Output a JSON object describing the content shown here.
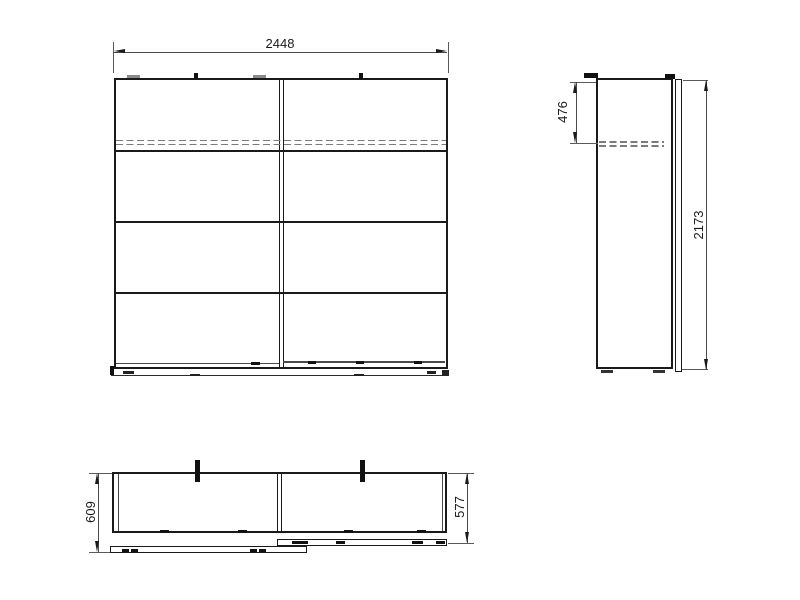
{
  "meta": {
    "background": "#ffffff",
    "object_line_color": "#1a1a1a",
    "dimension_line_color": "#4a4a4a",
    "hidden_line_color": "#7b7b7b"
  },
  "drawing": {
    "views": {
      "front": {
        "width_label": "2448"
      },
      "side": {
        "rail_depth_label": "476",
        "height_label": "2173"
      },
      "top": {
        "total_depth_label": "609",
        "carcass_depth_label": "577"
      }
    }
  }
}
